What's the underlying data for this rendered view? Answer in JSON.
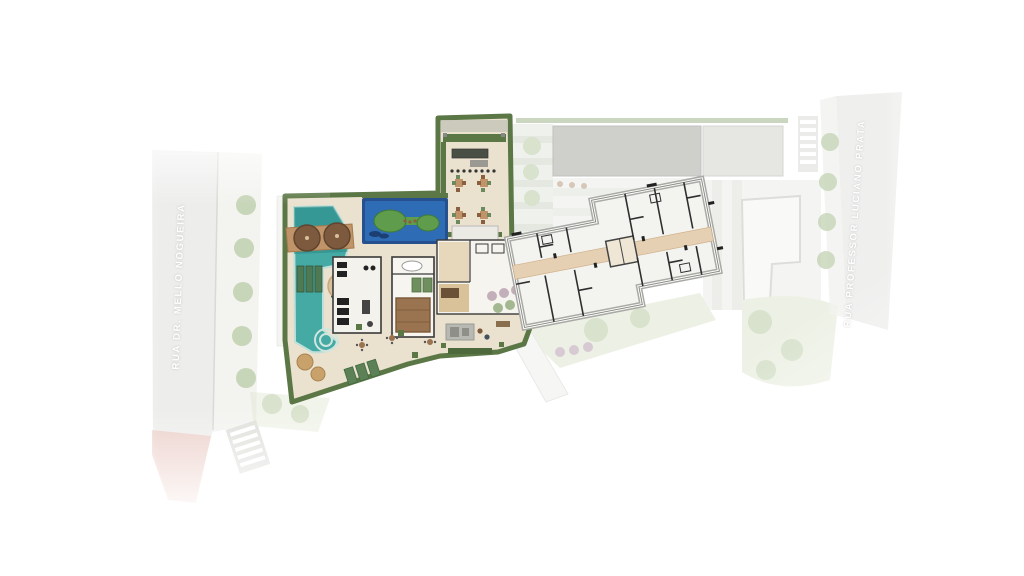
{
  "streets": {
    "left_label": "RUA DR. MELLO NOGUEIRA",
    "right_label": "RUA PROFESSOR LUCIANO PRATA"
  },
  "colors": {
    "background": "#ffffff",
    "street": "#ececea",
    "sidewalk": "#f2f2ef",
    "red_lane": "#eac0b8",
    "crosswalk_bg": "#dcdcd8",
    "deck": "#eae1cf",
    "hedge": "#5b7746",
    "pool_water": "#45a9a4",
    "pool_deep": "#2a8a88",
    "wood": "#c09468",
    "umbrella": "#7d5a3e",
    "leisure_border": "#27508f",
    "leisure_water": "#2e6db5",
    "island_green": "#5f9d4c",
    "gym_floor": "#f4f2ec",
    "wall_dark": "#3a3a3a",
    "tower_fill": "#f3f3f0",
    "tower_outline": "#a9a9a5",
    "corridor": "#e6d0b4",
    "lawn": "#dfe6d0",
    "tree": "#b9cba6",
    "planting_purple": "#b79fae",
    "roof_dark": "#a8a8a4",
    "roof_light": "#d2d2cc"
  },
  "regions": [
    "left-street",
    "left-sidewalk",
    "pedestrian-crosswalk",
    "amenity-deck",
    "party-terrace",
    "leisure-pool",
    "main-pool",
    "pool-wood-deck",
    "gym",
    "spa",
    "sauna",
    "lobby-building",
    "lounge-deck",
    "tower-floor-plan",
    "central-corridor",
    "elevator-core",
    "planting-strip",
    "lawn-area",
    "neighbor-roof",
    "neighbor-building",
    "right-street",
    "right-sidewalk"
  ]
}
